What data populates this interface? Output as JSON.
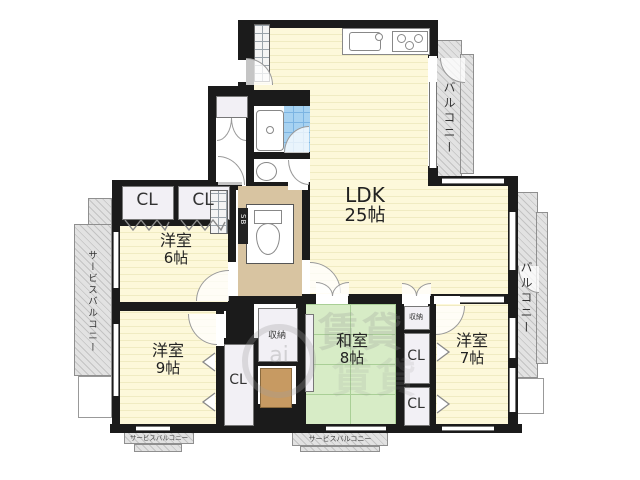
{
  "plan": {
    "rooms": {
      "ldk": {
        "name": "LDK",
        "size": "25帖"
      },
      "west6": {
        "name": "洋室",
        "size": "6帖"
      },
      "west9": {
        "name": "洋室",
        "size": "9帖"
      },
      "japanese8": {
        "name": "和室",
        "size": "8帖"
      },
      "west7": {
        "name": "洋室",
        "size": "7帖"
      }
    },
    "labels": {
      "cl": "CL",
      "storage": "収納",
      "sb": "SB",
      "balcony": "バルコニー",
      "service_balcony": "サービスバルコニー"
    },
    "watermark": {
      "circle_text": "ai",
      "text": "賃貸"
    },
    "colors": {
      "wall": "#1b1b1b",
      "room_yellow": "#fdf8da",
      "tatami_green": "#d7ecc6",
      "hall_tan": "#d8c4a1",
      "wood_brown": "#c79a62",
      "bath_blue": "#a7d2f1",
      "closet_gray": "#f2f0f5",
      "balcony_hatch": "#d2d2d2"
    }
  }
}
